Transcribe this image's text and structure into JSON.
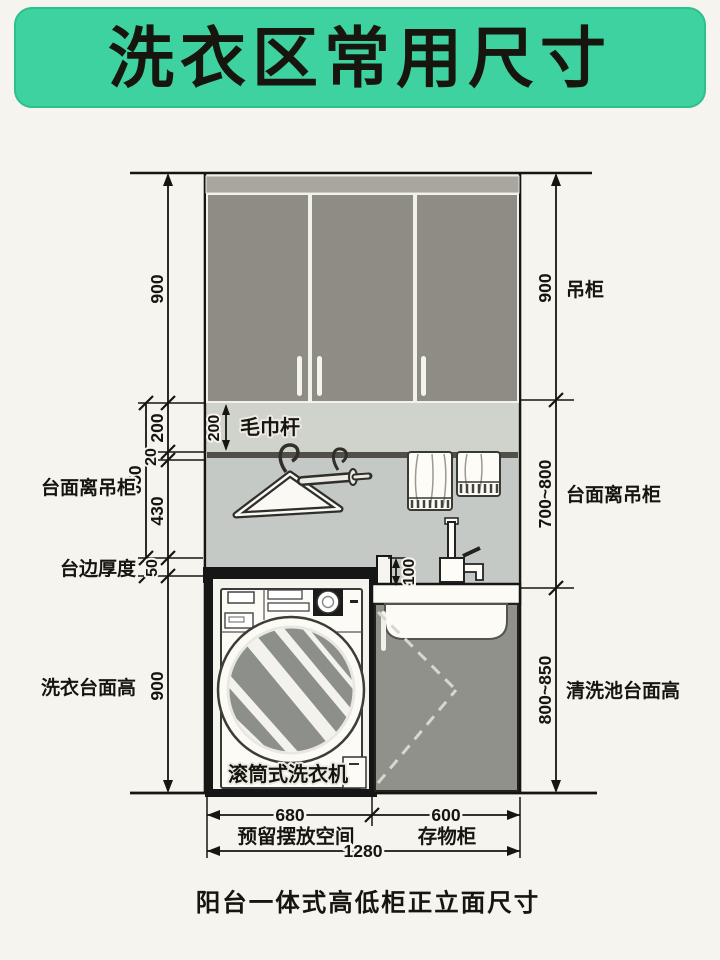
{
  "title": "洗衣区常用尺寸",
  "caption": "阳台一体式高低柜正立面尺寸",
  "colors": {
    "banner_green": "#3ed2a0",
    "cabinet_gray": "#8e8c84",
    "backsplash_gray": "#c4c9c6",
    "counter_black": "#161616",
    "background_cream": "#f6f4ee"
  },
  "dims": {
    "left": {
      "cabinet_height": "900",
      "towel_zone": "200",
      "trim": "20",
      "counter_to_cabinet": "650",
      "hang_space": "430",
      "counter_thickness": "50",
      "washer_counter_height": "900"
    },
    "right": {
      "cabinet_height": "900",
      "counter_to_cabinet": "700~800",
      "sink_counter_height": "800~850"
    },
    "inner": {
      "towel_bar_drop": "200",
      "counter_step": "100"
    },
    "bottom": {
      "washer_space": "680",
      "storage_cabinet": "600",
      "total_width": "1280"
    }
  },
  "labels": {
    "left": {
      "counter_to_cabinet": "台面离吊柜",
      "counter_edge_thickness": "台边厚度",
      "washer_counter_height": "洗衣台面高"
    },
    "right": {
      "wall_cabinet": "吊柜",
      "counter_to_cabinet": "台面离吊柜",
      "sink_counter_height": "清洗池台面高"
    },
    "inner": {
      "towel_bar": "毛巾杆",
      "washing_machine": "滚筒式洗衣机"
    },
    "bottom": {
      "washer_space": "预留摆放空间",
      "storage_cabinet": "存物柜"
    }
  }
}
